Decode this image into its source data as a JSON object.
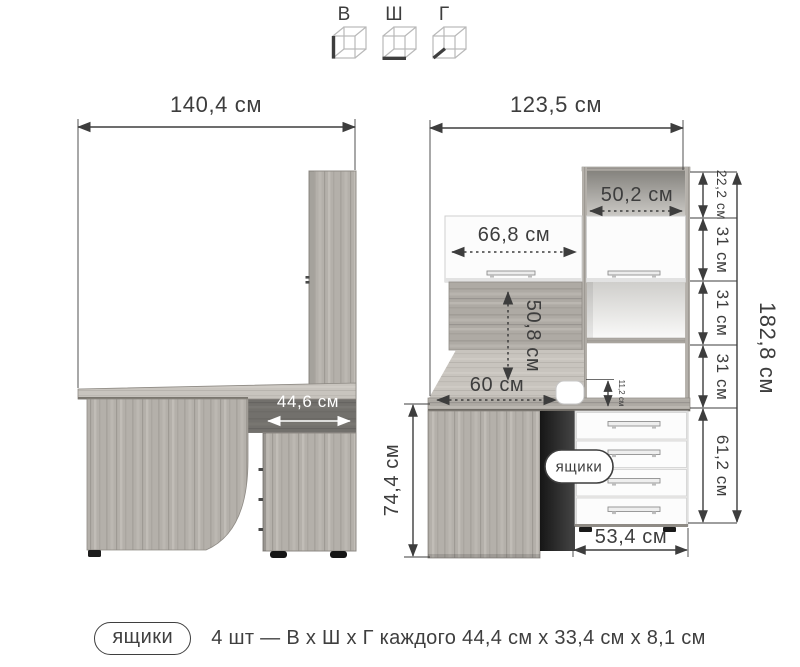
{
  "legend": {
    "items": [
      {
        "label": "В",
        "icon": "height-cube-icon"
      },
      {
        "label": "Ш",
        "icon": "width-cube-icon"
      },
      {
        "label": "Г",
        "icon": "depth-cube-icon"
      }
    ]
  },
  "side_view": {
    "width": "140,4 см",
    "pedestal_depth": "44,6 см"
  },
  "front_view": {
    "width": "123,5 см",
    "top_shelf_width": "50,2 см",
    "door_width": "66,8 см",
    "back_panel_height": "50,8 см",
    "desk_depth": "60 см",
    "grommet_height": "11,2 см",
    "desk_height": "74,4 см",
    "drawers_callout": "ящики",
    "drawer_unit_width": "53,4 см",
    "drawer_unit_height": "61,2 см",
    "shelf_heights": [
      "22,2 см",
      "31 см",
      "31 см",
      "31 см"
    ],
    "total_height": "182,8 см"
  },
  "caption": {
    "badge": "ящики",
    "text": "4 шт — В х Ш х Г каждого 44,4 см х 33,4 см х 8,1 см"
  },
  "colors": {
    "line": "#3d3d3d",
    "wood": "#b4b0aa",
    "panel_white": "#fcfcfc",
    "shadow_dark": "#1f1f1f"
  }
}
